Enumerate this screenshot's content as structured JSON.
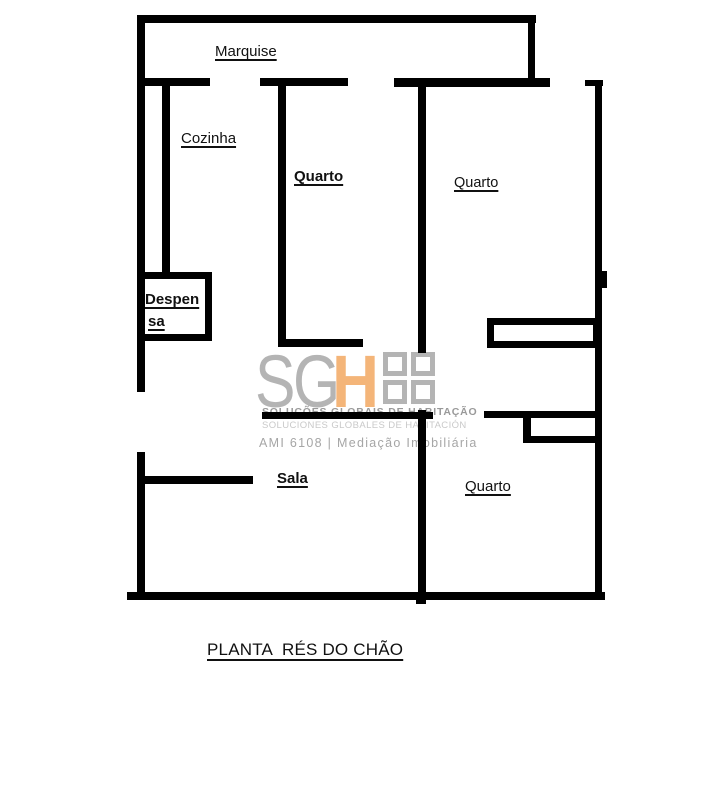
{
  "plan_title": "PLANTA  RÉS DO CHÃO",
  "rooms": {
    "marquise": "Marquise",
    "cozinha": "Cozinha",
    "quarto_top_left": "Quarto",
    "quarto_top_right": "Quarto",
    "despensa_line1": "Despen",
    "despensa_line2": "sa",
    "sala": "Sala",
    "quarto_bottom_right": "Quarto"
  },
  "watermark": {
    "brand_sg": "SG",
    "brand_h": "H",
    "tagline_pt": "SOLUÇÕES GLOBAIS DE HABITAÇÃO",
    "tagline_es": "SOLUCIONES GLOBALES DE HABITACIÓN",
    "license": "AMI 6108 | Mediação Imobiliária"
  },
  "colors": {
    "wall": "#000000",
    "background": "#ffffff",
    "brand_gray": "#b4b4b4",
    "brand_orange": "#f4b579",
    "tagline_pt_color": "#999999",
    "tagline_es_color": "#c9c9c9",
    "license_color": "#a6a6a6"
  }
}
